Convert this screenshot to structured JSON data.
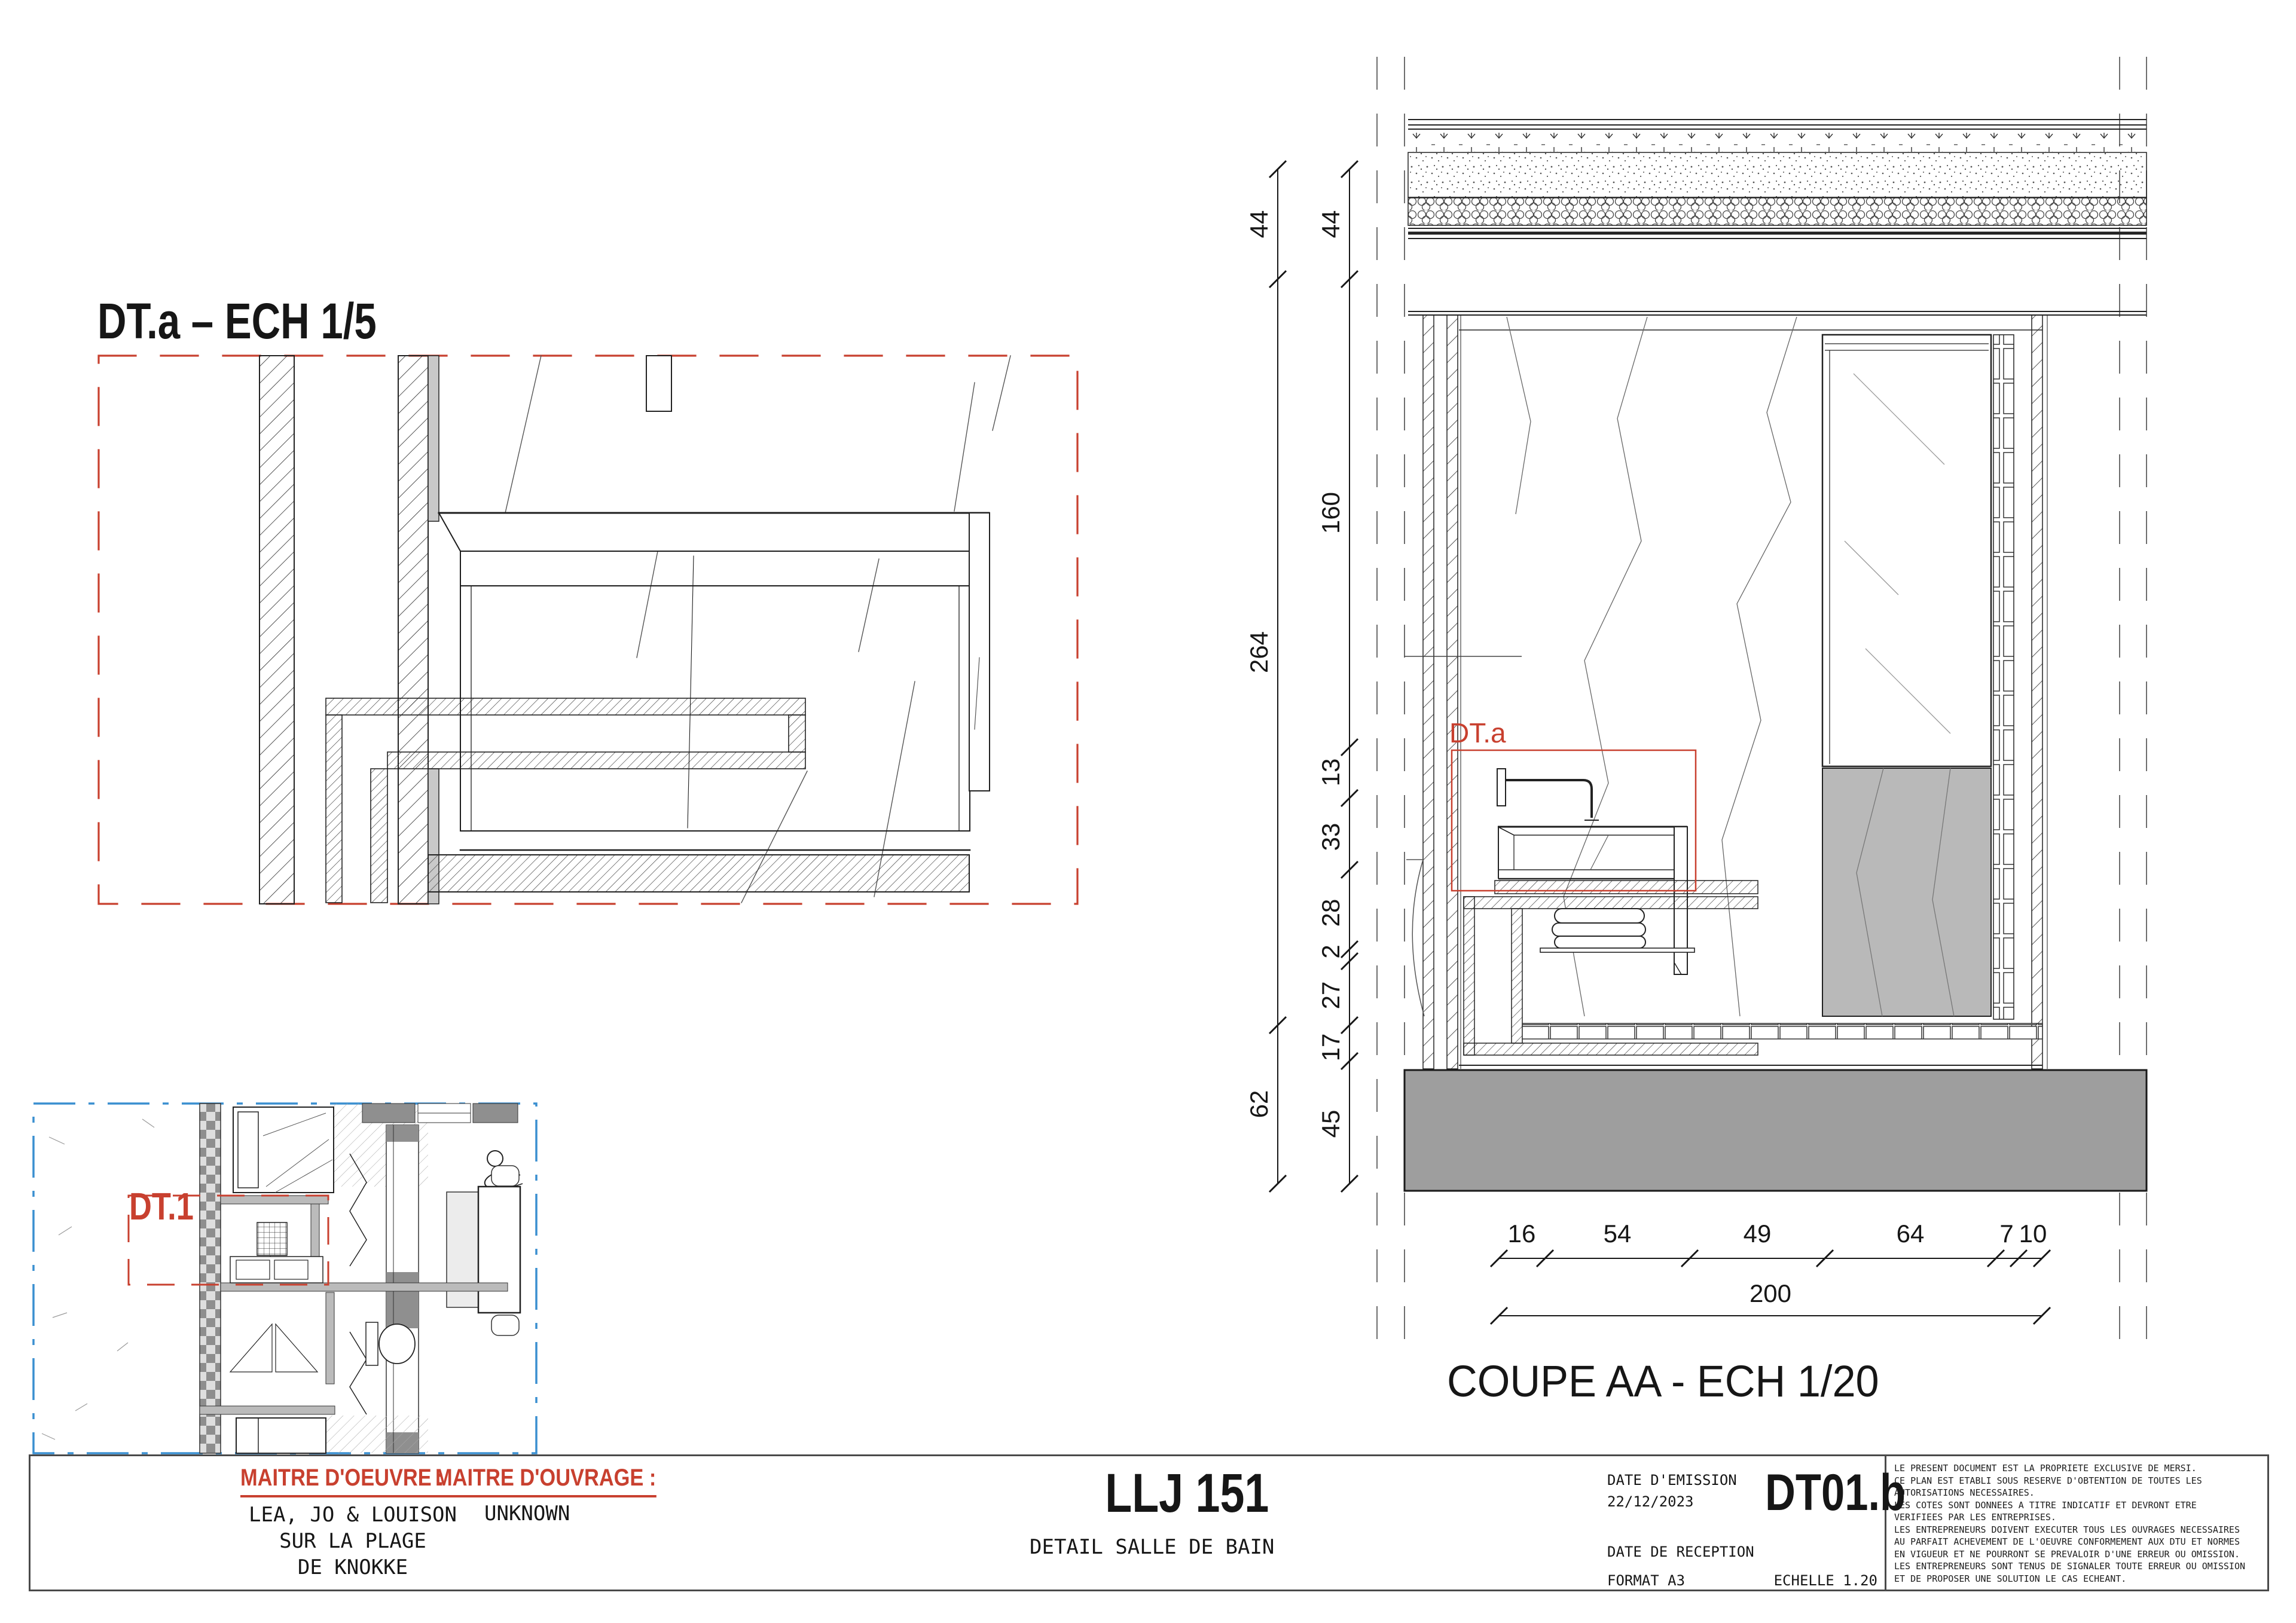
{
  "colors": {
    "accent_red": "#c8402f",
    "plan_blue": "#3a8fd0",
    "slab_gray": "#9e9e9e",
    "stone_gray": "#b9b9b9",
    "wardrobe_gray": "#8f8f8f",
    "line_dark": "#1f1f1f"
  },
  "detail_a": {
    "title": "DT.a – ECH 1/5"
  },
  "floor_plan": {
    "label": "DT.1"
  },
  "section": {
    "title": "COUPE AA - ECH 1/20",
    "detail_label": "DT.a",
    "dims_outer": [
      "44",
      "264",
      "62"
    ],
    "dims_inner": [
      "44",
      "160",
      "13",
      "33",
      "28",
      "2",
      "27",
      "17",
      "45"
    ],
    "dims_bottom": [
      "16",
      "54",
      "49",
      "64",
      "7",
      "10"
    ],
    "dim_total": "200"
  },
  "title_block": {
    "maitre_oeuvre_label": "MAITRE D'OEUVRE :",
    "maitre_ouvrage_label": "MAITRE D'OUVRAGE :",
    "oeuvre_line1": "LEA, JO & LOUISON",
    "oeuvre_line2": "SUR LA PLAGE",
    "oeuvre_line3": "DE KNOKKE",
    "ouvrage_value": "UNKNOWN",
    "project_code": "LLJ 151",
    "project_title": "DETAIL SALLE DE BAIN",
    "date_emission_label": "DATE D'EMISSION",
    "date_emission_value": "22/12/2023",
    "date_reception_label": "DATE DE RECEPTION",
    "format_label": "FORMAT A3",
    "scale_label": "ECHELLE 1.20",
    "sheet_code": "DT01.b",
    "legal_lines": [
      "LE PRESENT DOCUMENT EST LA PROPRIETE EXCLUSIVE DE MERSI.",
      "CE PLAN EST ETABLI SOUS RESERVE D'OBTENTION DE TOUTES LES",
      "AUTORISATIONS NECESSAIRES.",
      "LES COTES SONT DONNEES A TITRE INDICATIF ET DEVRONT ETRE",
      "VERIFIEES PAR LES ENTREPRISES.",
      "LES ENTREPRENEURS DOIVENT EXECUTER TOUS LES OUVRAGES NECESSAIRES",
      "AU PARFAIT ACHEVEMENT DE L'OEUVRE CONFORMEMENT AUX DTU ET NORMES",
      "EN VIGUEUR ET NE POURRONT SE PREVALOIR D'UNE ERREUR OU OMISSION.",
      "LES ENTREPRENEURS SONT TENUS DE SIGNALER TOUTE ERREUR OU OMISSION",
      "ET DE PROPOSER UNE SOLUTION LE CAS ECHEANT."
    ]
  }
}
